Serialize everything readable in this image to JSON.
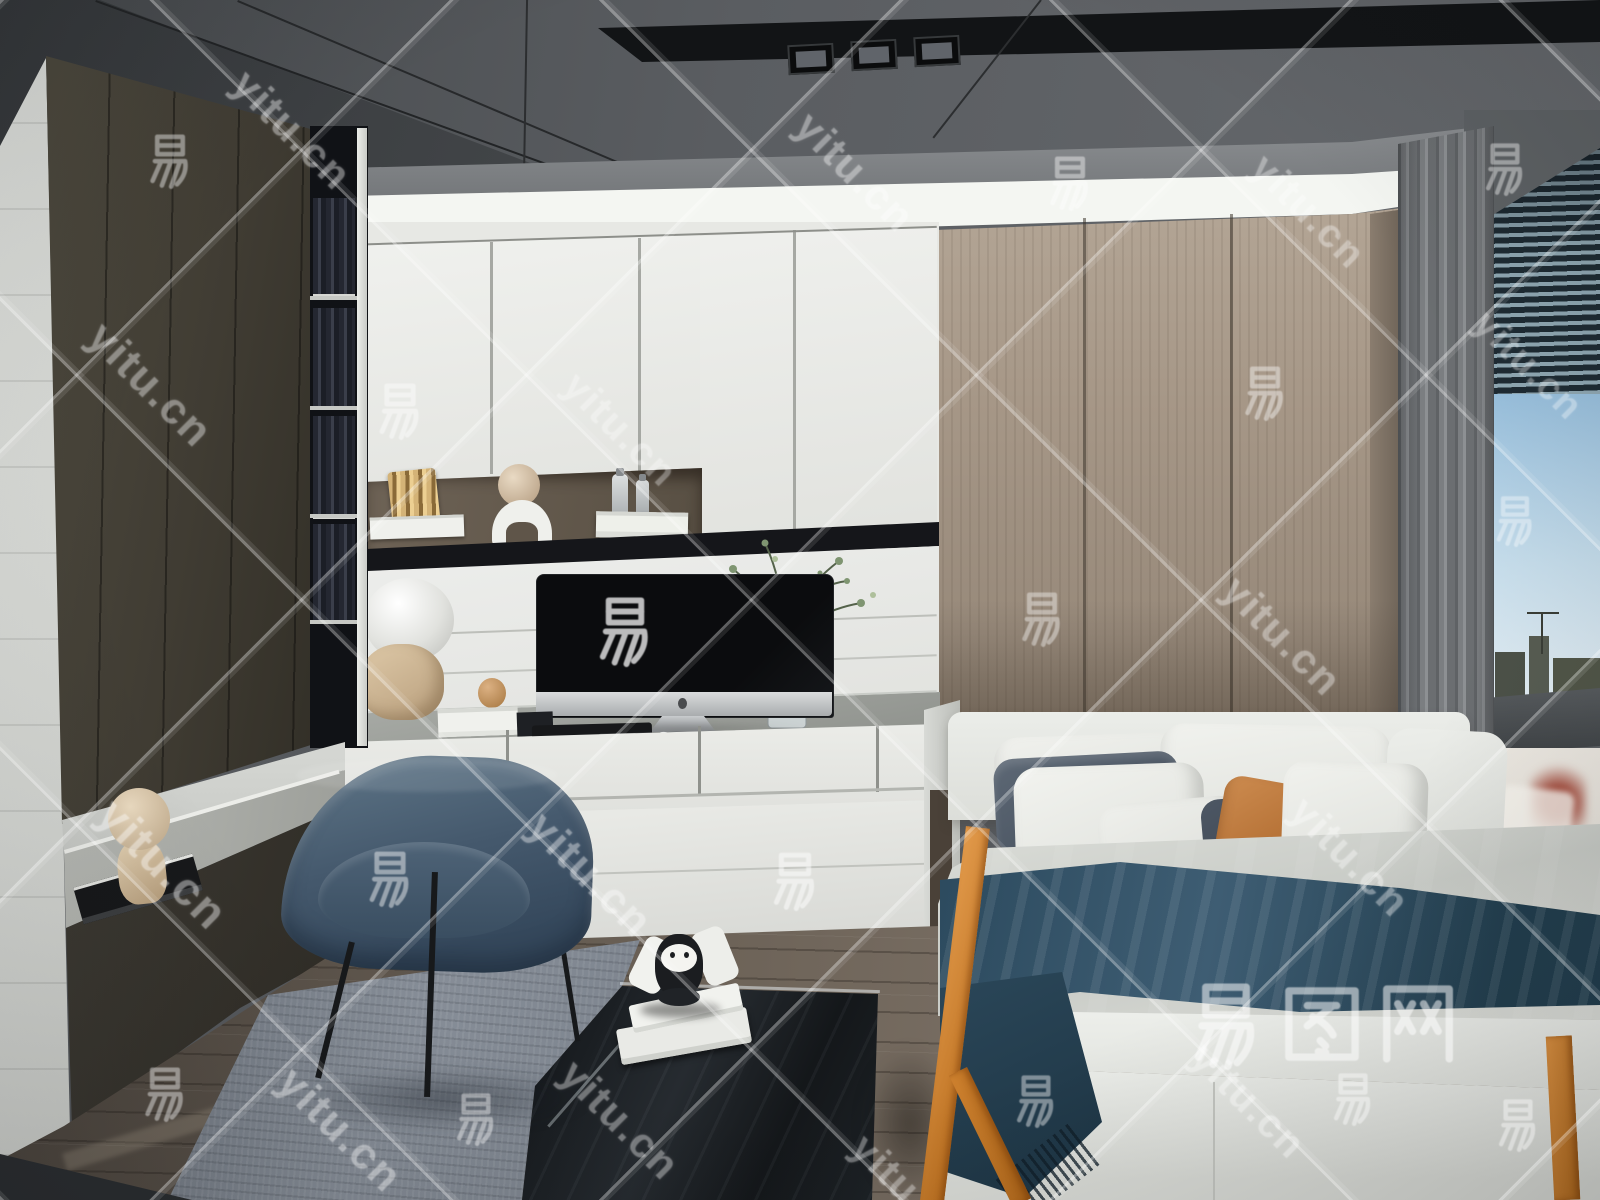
{
  "image": {
    "description": "3D interior rendering of a modern bedroom study: dark gray ceiling with recessed lights and LED cove, charcoal wardrobe and bookshelf on the left, white built-in desk wall unit with an iMac and decor figurines, blue fabric desk chair on a gray rug, taupe wood wardrobe panels, gray curtain and window with blinds and city view on the right, and a bed with white, slate and orange pillows, a dark blue throw blanket and orange wood frame accents."
  },
  "watermark": {
    "domain_text": "yitu.cn",
    "char_text": "易",
    "logo_text": "易图网",
    "line_opacity": 0.34,
    "line_spacing_px": 318,
    "text_items": [
      {
        "type": "char",
        "x": 170,
        "y": 160,
        "size": 58,
        "rot": 0,
        "opacity": 0.42
      },
      {
        "type": "char",
        "x": 1070,
        "y": 182,
        "size": 58,
        "rot": 0,
        "opacity": 0.42
      },
      {
        "type": "char",
        "x": 1505,
        "y": 168,
        "size": 56,
        "rot": 0,
        "opacity": 0.4
      },
      {
        "type": "char",
        "x": 400,
        "y": 410,
        "size": 60,
        "rot": 0,
        "opacity": 0.45
      },
      {
        "type": "char",
        "x": 1265,
        "y": 392,
        "size": 58,
        "rot": 0,
        "opacity": 0.42
      },
      {
        "type": "char",
        "x": 625,
        "y": 630,
        "size": 74,
        "rot": 0,
        "opacity": 0.72
      },
      {
        "type": "char",
        "x": 1042,
        "y": 618,
        "size": 58,
        "rot": 0,
        "opacity": 0.4
      },
      {
        "type": "char",
        "x": 1515,
        "y": 520,
        "size": 54,
        "rot": 0,
        "opacity": 0.38
      },
      {
        "type": "char",
        "x": 390,
        "y": 878,
        "size": 60,
        "rot": 0,
        "opacity": 0.45
      },
      {
        "type": "char",
        "x": 795,
        "y": 880,
        "size": 62,
        "rot": 0,
        "opacity": 0.5
      },
      {
        "type": "char",
        "x": 165,
        "y": 1093,
        "size": 58,
        "rot": 0,
        "opacity": 0.42
      },
      {
        "type": "char",
        "x": 476,
        "y": 1118,
        "size": 56,
        "rot": 0,
        "opacity": 0.4
      },
      {
        "type": "char",
        "x": 1036,
        "y": 1100,
        "size": 56,
        "rot": 0,
        "opacity": 0.42
      },
      {
        "type": "char",
        "x": 1353,
        "y": 1098,
        "size": 56,
        "rot": 0,
        "opacity": 0.42
      },
      {
        "type": "char",
        "x": 1518,
        "y": 1124,
        "size": 56,
        "rot": 0,
        "opacity": 0.42
      },
      {
        "type": "domain",
        "x": 292,
        "y": 130,
        "size": 42,
        "rot": 45,
        "opacity": 0.4
      },
      {
        "type": "domain",
        "x": 855,
        "y": 172,
        "size": 42,
        "rot": 45,
        "opacity": 0.4
      },
      {
        "type": "domain",
        "x": 1308,
        "y": 212,
        "size": 40,
        "rot": 45,
        "opacity": 0.36
      },
      {
        "type": "domain",
        "x": 150,
        "y": 385,
        "size": 44,
        "rot": 45,
        "opacity": 0.4
      },
      {
        "type": "domain",
        "x": 620,
        "y": 430,
        "size": 40,
        "rot": 45,
        "opacity": 0.34
      },
      {
        "type": "domain",
        "x": 1528,
        "y": 366,
        "size": 38,
        "rot": 45,
        "opacity": 0.34
      },
      {
        "type": "domain",
        "x": 1282,
        "y": 636,
        "size": 42,
        "rot": 45,
        "opacity": 0.38
      },
      {
        "type": "domain",
        "x": 163,
        "y": 864,
        "size": 46,
        "rot": 45,
        "opacity": 0.42
      },
      {
        "type": "domain",
        "x": 590,
        "y": 875,
        "size": 44,
        "rot": 45,
        "opacity": 0.4
      },
      {
        "type": "domain",
        "x": 1350,
        "y": 857,
        "size": 42,
        "rot": 45,
        "opacity": 0.38
      },
      {
        "type": "domain",
        "x": 340,
        "y": 1130,
        "size": 44,
        "rot": 45,
        "opacity": 0.4
      },
      {
        "type": "domain",
        "x": 620,
        "y": 1120,
        "size": 42,
        "rot": 45,
        "opacity": 0.38
      },
      {
        "type": "domain",
        "x": 908,
        "y": 1192,
        "size": 40,
        "rot": 45,
        "opacity": 0.36
      }
    ],
    "logo": {
      "x": 1180,
      "y": 978,
      "size": 92,
      "opacity": 0.52
    },
    "logo_sub": {
      "x": 1248,
      "y": 1102,
      "size": 40,
      "rot": 45,
      "opacity": 0.38
    }
  },
  "palette": {
    "cove_light": "#f4f6f2",
    "ceiling_gray": "#56595d",
    "left_cabinet": "#403c33",
    "white_cabinet": "#e9eae6",
    "niche_back": "#584f43",
    "wardrobe_tan": "#a69787",
    "curtain_gray": "#6b6e71",
    "sky_blue": "#98bfdc",
    "chair_blue": "#45596d",
    "blanket_blue": "#3e5d73",
    "pillow_slate": "#414b58",
    "pillow_orange": "#a55f24",
    "accent_orange_wood": "#b96d1d",
    "rug_gray": "#868d97",
    "floor_wood": "#6d6358",
    "table_black": "#14171a"
  },
  "scene": {
    "objects": [
      "ceiling-led-cove",
      "recessed-ceiling-lights",
      "dark-wardrobe-left",
      "bookshelf-column",
      "wall-niche-decor",
      "built-in-desk",
      "imac-computer",
      "keyboard",
      "astronaut-figurine",
      "vase-with-branches",
      "blue-desk-chair",
      "wood-wardrobe-right",
      "gray-curtain",
      "window-with-blinds",
      "city-view",
      "bed",
      "pillows",
      "blue-throw-blanket",
      "orange-bed-frame",
      "gray-rug",
      "black-coffee-table",
      "stacked-books",
      "toy-figurine",
      "wood-floor"
    ]
  }
}
